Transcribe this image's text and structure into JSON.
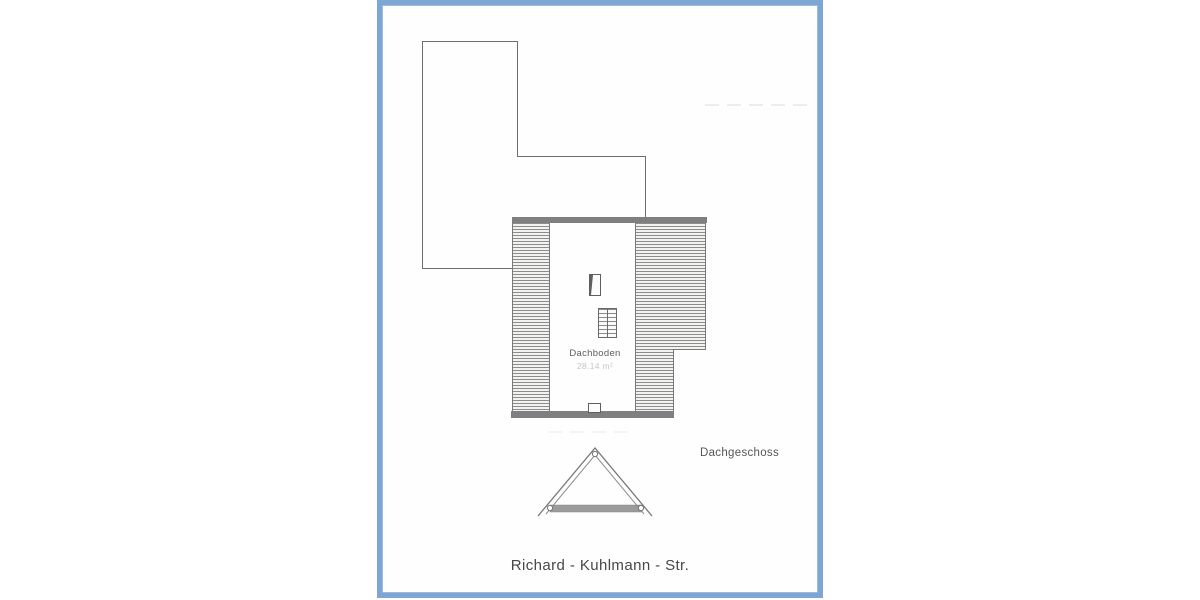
{
  "frame": {
    "color": "#7da6d4"
  },
  "drawing": {
    "attic_plan": {
      "room_label": "Dachboden",
      "area_label": "28.14 m²"
    },
    "section_label": "Dachgeschoss",
    "title": "Richard - Kuhlmann - Str."
  },
  "colors": {
    "frame_blue": "#7da6d4",
    "outline_gray": "#6e6e6e",
    "wall_band_gray": "#7e7f81",
    "hatch_gray": "#8c8c8c",
    "label_gray": "#565656",
    "faint_area_gray": "#c6c6c6"
  }
}
